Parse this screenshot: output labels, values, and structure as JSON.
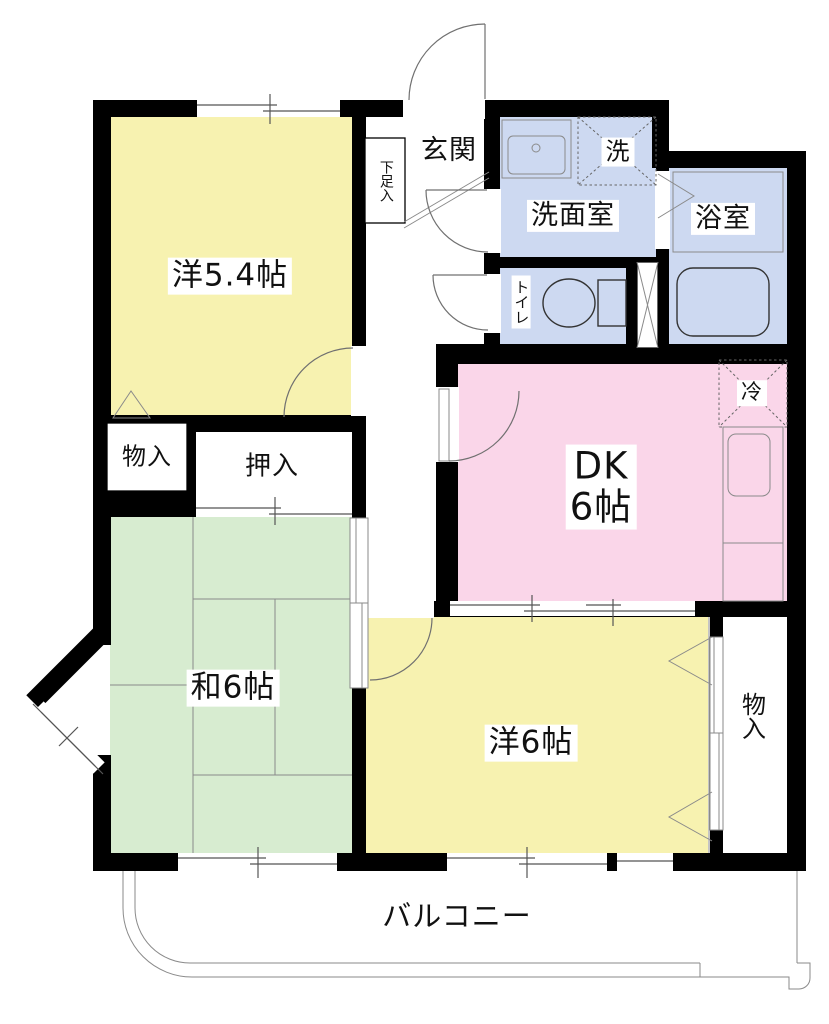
{
  "labels": {
    "room_yo54": "洋5.4帖",
    "entrance": "玄関",
    "shoe_cabinet": "下足入",
    "washroom": "洗面室",
    "washer": "洗",
    "bathroom": "浴室",
    "toilet": "トイレ",
    "dk_line1": "DK",
    "dk_line2": "6帖",
    "fridge": "冷",
    "storage_left": "物入",
    "closet": "押入",
    "room_wa6": "和6帖",
    "room_yo6": "洋6帖",
    "storage_right": "物入",
    "balcony": "バルコニー"
  },
  "colors": {
    "wall": "#000000",
    "room-yellow": "#f7f2b0",
    "room-green": "#d7ecd0",
    "room-pink": "#fad6e9",
    "room-blue": "#cdd9f1",
    "label-bg": "#ffffff",
    "text": "#111111",
    "line": "#707070"
  }
}
